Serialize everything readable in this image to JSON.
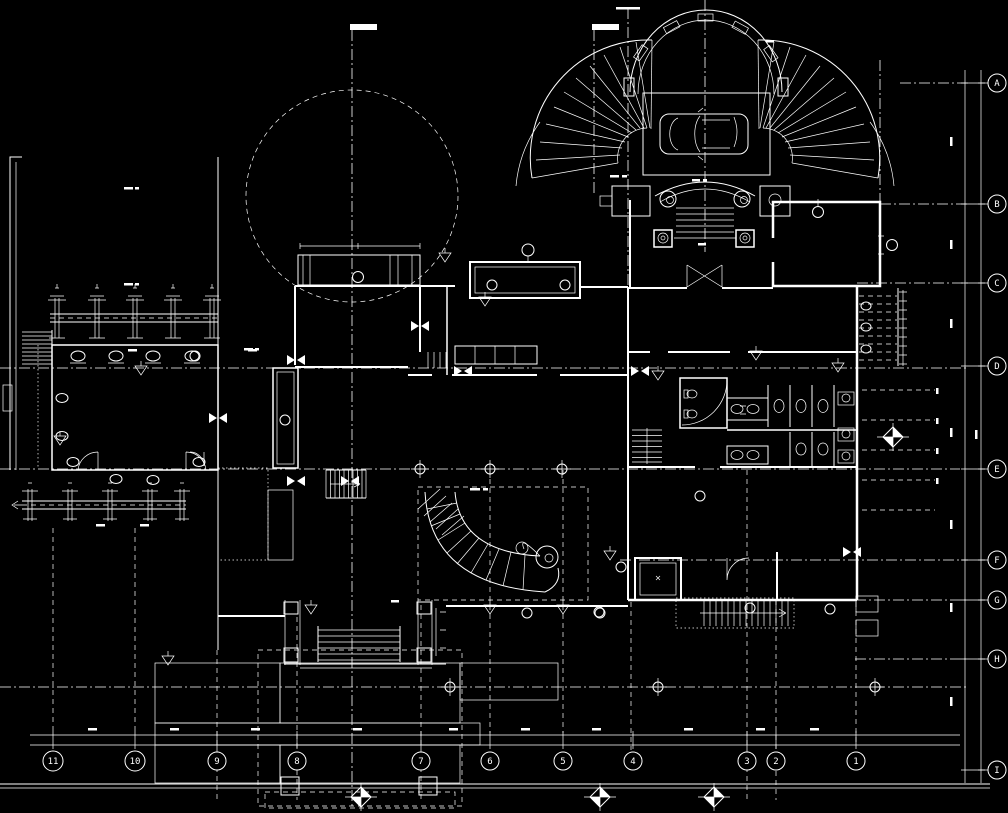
{
  "drawing": {
    "kind": "architectural floor plan (CAD, dark background)",
    "background": "#000000",
    "ink": "#ffffff"
  },
  "grid_bubbles": {
    "right": [
      "A",
      "B",
      "C",
      "D",
      "E",
      "F",
      "G",
      "H",
      "I"
    ],
    "bottom": [
      "11",
      "10",
      "9",
      "8",
      "7",
      "6",
      "5",
      "4",
      "3",
      "2",
      "1"
    ]
  }
}
